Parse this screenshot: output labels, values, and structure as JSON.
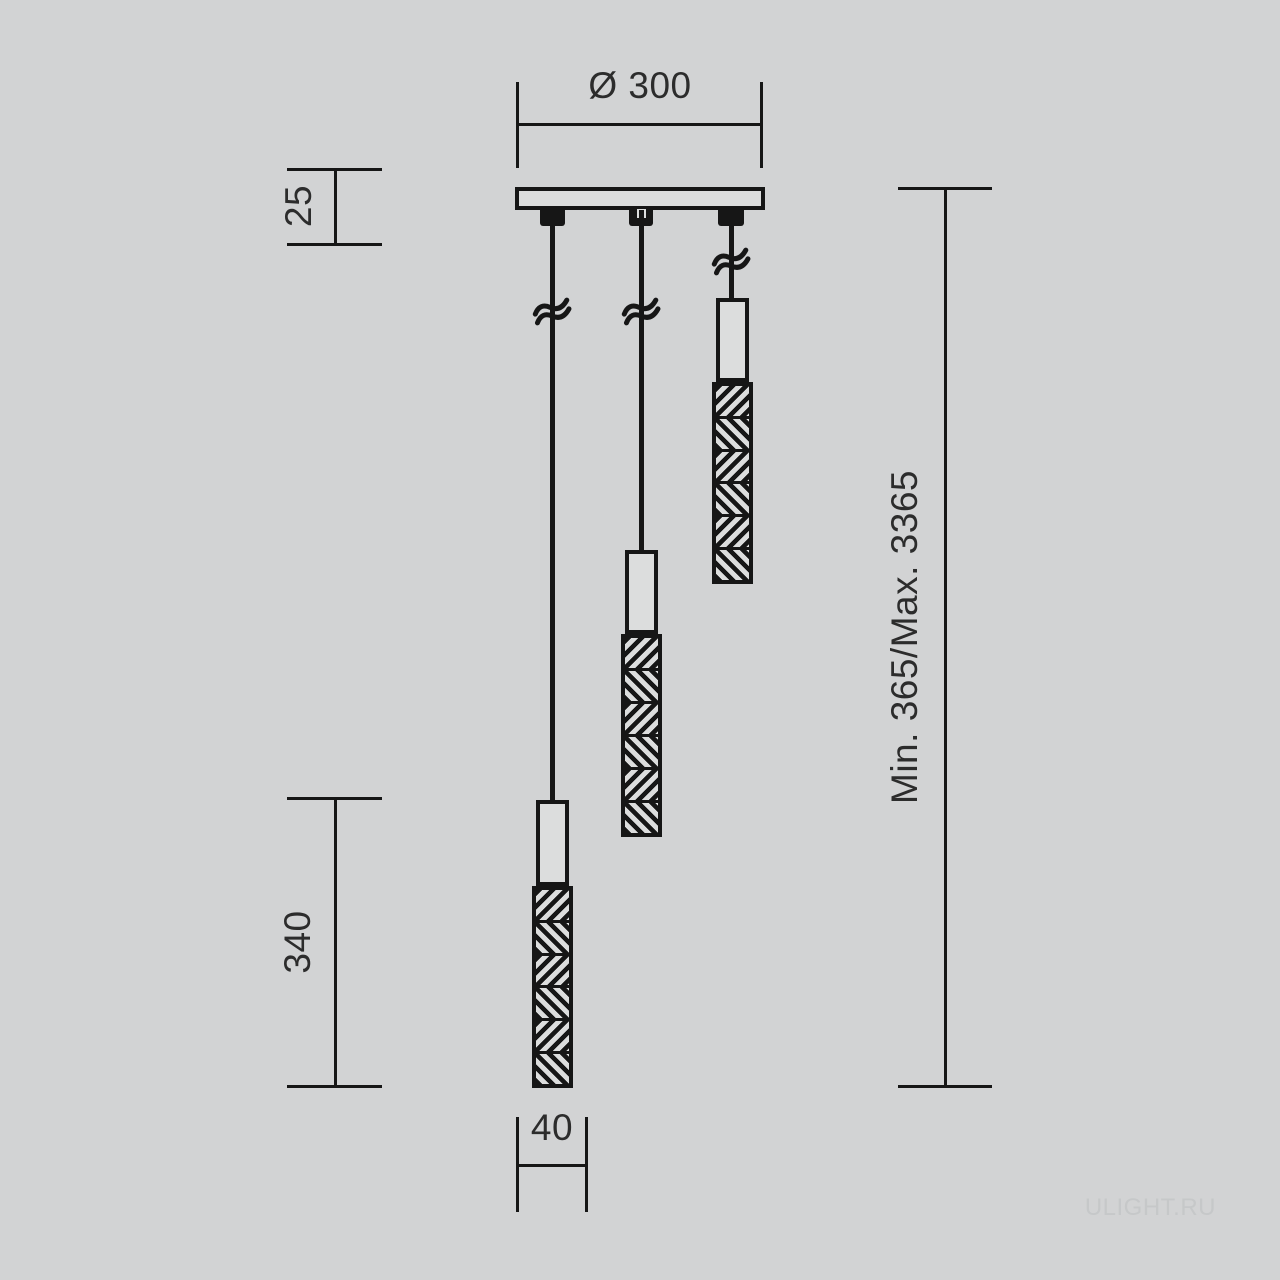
{
  "colors": {
    "bg": "#d2d3d4",
    "line": "#161616",
    "text": "#2c2c2c",
    "fill": "#dcdddd",
    "wm": "#c6c8c9"
  },
  "dimensions": {
    "diameter": "Ø 300",
    "canopy_height": "25",
    "lamp_length": "340",
    "suspension_range": "Min. 365/Max. 3365",
    "lamp_width": "40"
  },
  "watermark": {
    "text": "ULIGHT.RU"
  }
}
